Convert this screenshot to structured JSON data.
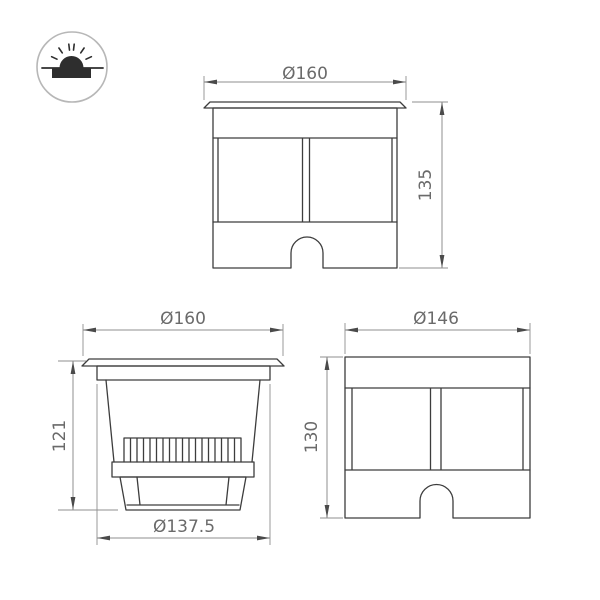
{
  "icon": {
    "name": "inground-light-icon"
  },
  "views": {
    "front_with_flange": {
      "width_dim": "Ø160",
      "height_dim": "135"
    },
    "side_with_flange": {
      "flange_dim": "Ø160",
      "depth_dim": "121",
      "body_dim": "Ø137.5"
    },
    "body_front": {
      "width_dim": "Ø146",
      "height_dim": "130"
    }
  },
  "colors": {
    "background": "#ffffff",
    "outline": "#3d3d3d",
    "dimline": "#8f8f8f",
    "arrow": "#4a4a4a",
    "dimtext": "#6a6a6a",
    "iconring": "#b7b7b7",
    "iconfill": "#2e2e2e"
  }
}
